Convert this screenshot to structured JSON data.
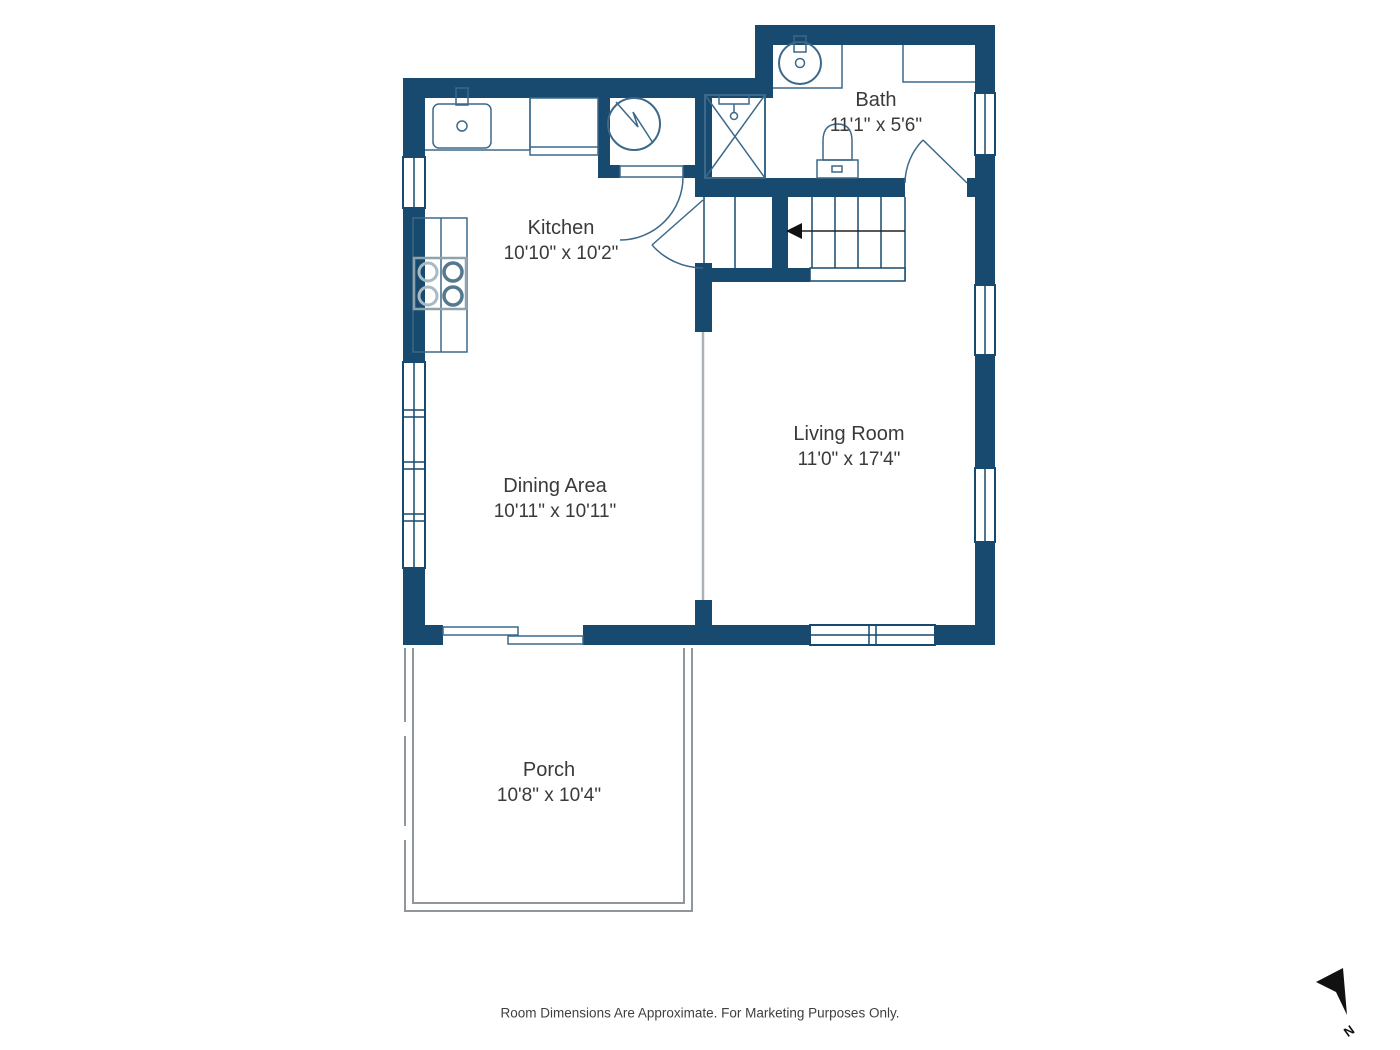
{
  "footer": "Room Dimensions Are Approximate. For Marketing Purposes Only.",
  "compass": {
    "label": "N"
  },
  "rooms": {
    "bath": {
      "name": "Bath",
      "dims": "11'1\" x 5'6\""
    },
    "kitchen": {
      "name": "Kitchen",
      "dims": "10'10\" x 10'2\""
    },
    "living": {
      "name": "Living Room",
      "dims": "11'0\" x 17'4\""
    },
    "dining": {
      "name": "Dining Area",
      "dims": "10'11\" x 10'11\""
    },
    "porch": {
      "name": "Porch",
      "dims": "10'8\" x 10'4\""
    }
  },
  "colors": {
    "wall": "#174a6e",
    "fixture_line": "#3c6889",
    "porch_line": "#8e979e",
    "text": "#3a3a3a",
    "north_arrow": "#111111"
  }
}
